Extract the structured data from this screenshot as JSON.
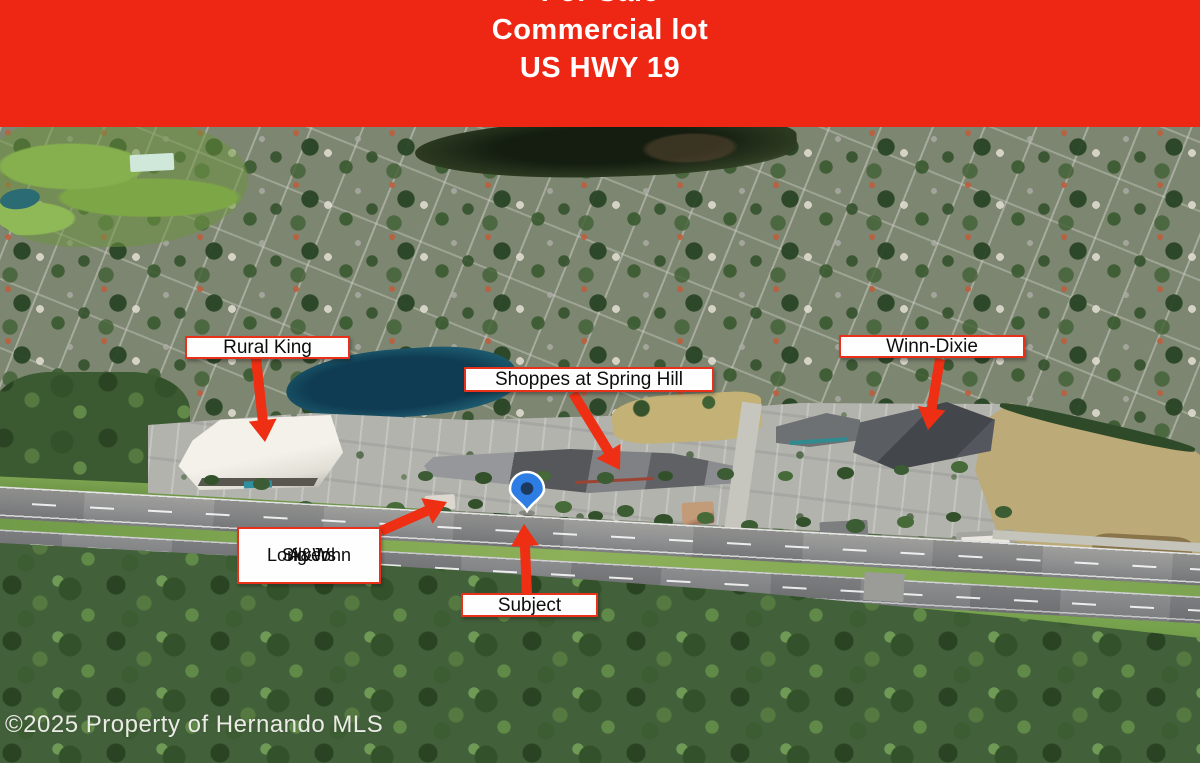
{
  "banner": {
    "lines": [
      "For Sale",
      "Commercial lot",
      "US HWY 19"
    ],
    "bg_color": "#ee2715",
    "text_color": "#ffffff"
  },
  "annotations": {
    "accent_red": "#ef2f13",
    "label_border_red": "#e8301a",
    "labels": [
      {
        "text": "Rural King"
      },
      {
        "text": "Shoppes at Spring Hill"
      },
      {
        "text": "Winn-Dixie"
      },
      {
        "lines": [
          "A&W",
          "Long John",
          "Silvers"
        ]
      },
      {
        "text": "Subject"
      }
    ],
    "marker": {
      "name": "subject-location-pin",
      "fill": "#2e7de5",
      "center_dot": "#1d3a5e"
    }
  },
  "footer": {
    "copyright": "©2025 Property of Hernando MLS"
  }
}
